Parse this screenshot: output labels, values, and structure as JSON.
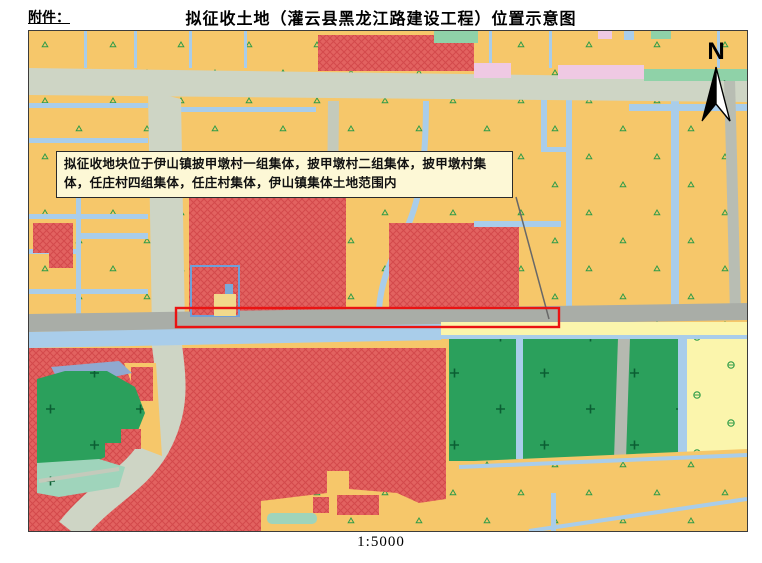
{
  "header": {
    "attachment_label": "附件：",
    "title": "拟征收土地（灌云县黑龙江路建设工程）位置示意图"
  },
  "map": {
    "annotation_text": "拟征收地块位于伊山镇披甲墩村一组集体，披甲墩村二组集体，披甲墩村集体，任庄村四组集体，任庄村集体，伊山镇集体土地范围内",
    "north_label": "N",
    "scale_text": "1:5000",
    "legend_semantics": {
      "highlight_rectangle": "拟征收土地范围（黑龙江路）",
      "red_hatched_parcels": "建设用地",
      "orange_parcels": "农用地",
      "green_parcels": "林地/绿地",
      "blue_lines": "河渠",
      "gray_bands": "道路"
    },
    "colors": {
      "parcel_orange": "#f6c76a",
      "parcel_red": "#e26260",
      "red_hatch_line": "#d34a4c",
      "parcel_green": "#2ba05c",
      "parcel_pale_yellow": "#fbf5ac",
      "parcel_pink": "#efc9e3",
      "strip_light_green": "#8fd2a8",
      "road_light": "#ced5c5",
      "road_dark": "#a9ada7",
      "canal_blue": "#a9cdea",
      "water_gray_blue": "#8fa9d0",
      "highlight_red": "#ea1312",
      "annotation_bg": "#fdf8d6"
    }
  }
}
